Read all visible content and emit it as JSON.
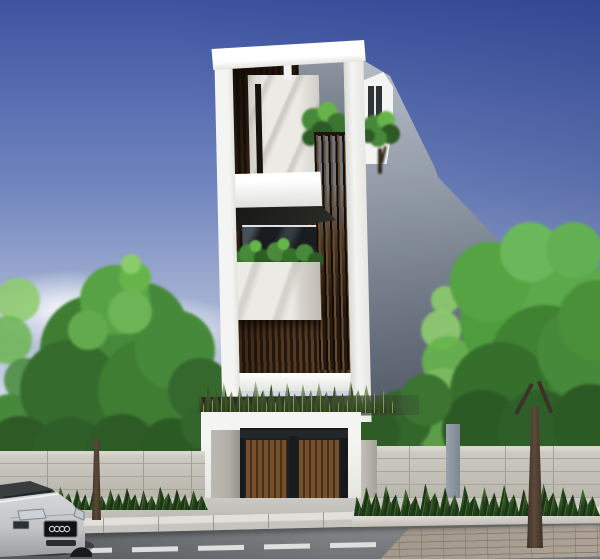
{
  "scene": {
    "type": "architectural-exterior-rendering",
    "description": "Daylight 3D rendering of a tall narrow modern townhouse with a white rectangular facade frame, marble feature wall, dark timber slat screens, planted balconies and a roof garden. A white entrance gate with brown wooden doors sits behind a concrete block perimeter fence lined with spiky plants. Green street trees flank the house, a concrete sidewalk and curb run along an asphalt road with a dashed white lane line, and the front of a silver sedan is parked at the lower left.",
    "time_of_day": "day",
    "weather": "clear blue sky with faint clouds near the horizon",
    "visible_text": "none",
    "objects": [
      "sky",
      "clouds",
      "building-side-wall",
      "roof-frame",
      "main-facade-frame",
      "marble-wall-panel",
      "wood-slat-wall",
      "slat-railing-screen",
      "white-balcony-box",
      "window-glass",
      "marble-planter-box",
      "balcony-plants",
      "roof-garden-plants",
      "entrance-gate",
      "gate-grass-planter",
      "concrete-gate-pillar",
      "wooden-gate-doors",
      "perimeter-fence-left",
      "perimeter-fence-right",
      "fence-posts",
      "spiky-ground-plants",
      "street-trees-left",
      "street-trees-right",
      "tree-trunks",
      "sidewalk",
      "curb",
      "asphalt-road",
      "dashed-lane-line",
      "brick-pavement-corner",
      "silver-sedan-front"
    ]
  },
  "palette": {
    "sky_top": "#3d53a0",
    "sky_mid": "#7287c0",
    "sky_low": "#b6c1d9",
    "sky_horizon": "#e3e8ef",
    "wall_light": "#aeb6c1",
    "wall_mid": "#8b95a1",
    "wall_dark": "#667080",
    "facade_white": "#f4f4f2",
    "marble_light": "#eceae5",
    "marble_shadow": "#cfcdc6",
    "wood_dark": "#241a10",
    "wood_light": "#6b4a2e",
    "glass_dark": "#191d20",
    "door_wood": "#74502c",
    "door_wood_dark": "#46301a",
    "pillar_concrete": "#b2afa8",
    "grass_dark": "#3a5226",
    "grass_light": "#7d9a55",
    "tree_dark": "#2e5a26",
    "tree_mid": "#47893a",
    "tree_light": "#66b54a",
    "tree_pale": "#8ccb6a",
    "trunk": "#5c4a39",
    "trunk_dark": "#3e3128",
    "fence_light": "#cdcac2",
    "fence_joint": "#a8a59c",
    "fence_shade": "#b5b2aa",
    "sidewalk": "#c6c4be",
    "curb_top": "#e2e0da",
    "curb_face": "#c6c4be",
    "road": "#85888b",
    "road_dark": "#63666a",
    "road_line": "#e8e8e6",
    "brick": "#a2988c",
    "brick_joint": "#897e72",
    "car_body": "#d6d7d9",
    "car_body_dark": "#9b9da0",
    "car_glass": "#1e2124"
  }
}
